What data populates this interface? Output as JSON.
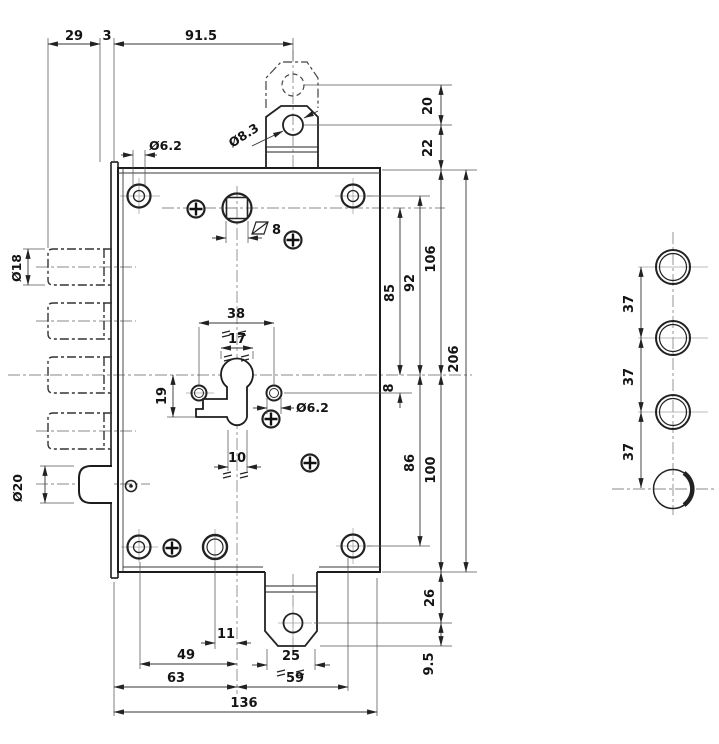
{
  "dims": {
    "top": {
      "v29": "29",
      "v3": "3",
      "v915": "91.5"
    },
    "tab": {
      "v20": "20",
      "v22": "22",
      "dia83": "Ø8.3"
    },
    "left": {
      "dia18": "Ø18",
      "dia20": "Ø20",
      "dia62": "Ø6.2"
    },
    "center": {
      "sq8": "8",
      "v38": "38",
      "v17": "17",
      "v19": "19",
      "v10": "10",
      "dia62": "Ø6.2"
    },
    "right": {
      "v85": "85",
      "v92": "92",
      "v106": "106",
      "v8": "8",
      "v206": "206",
      "v86": "86",
      "v100": "100",
      "v26": "26",
      "v95": "9.5"
    },
    "bottom": {
      "v11": "11",
      "v49": "49",
      "v25": "25",
      "v63": "63",
      "v59": "59",
      "v136": "136"
    },
    "side": {
      "v37a": "37",
      "v37b": "37",
      "v37c": "37"
    }
  }
}
